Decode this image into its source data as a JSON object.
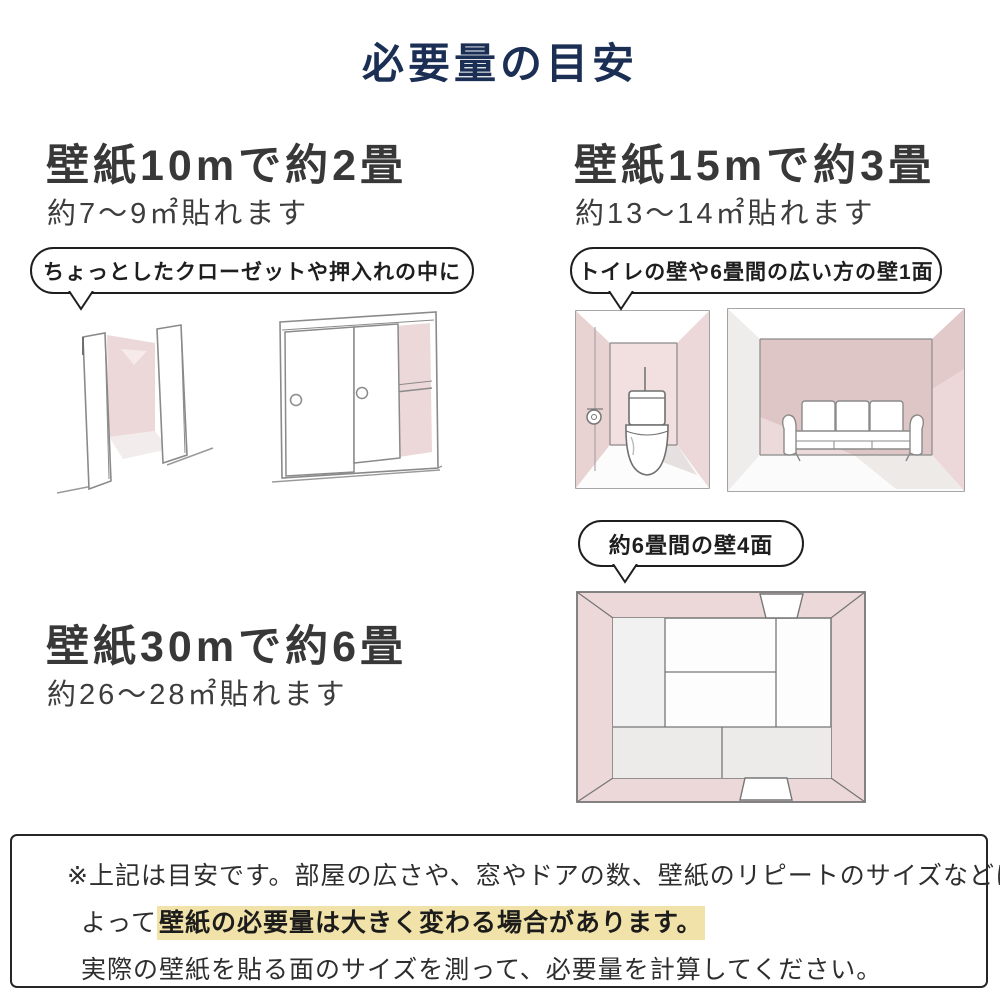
{
  "title": "必要量の目安",
  "sections": [
    {
      "heading": "壁紙10mで約2畳",
      "subheading": "約7〜9㎡貼れます",
      "bubble": "ちょっとしたクローゼットや押入れの中に"
    },
    {
      "heading": "壁紙15mで約3畳",
      "subheading": "約13〜14㎡貼れます",
      "bubble": "トイレの壁や6畳間の広い方の壁1面"
    },
    {
      "heading": "壁紙30mで約6畳",
      "subheading": "約26〜28㎡貼れます",
      "bubble": "約6畳間の壁4面"
    }
  ],
  "note": {
    "line1": "※上記は目安です。部屋の広さや、窓やドアの数、壁紙のリピートのサイズなどに",
    "line2_prefix": "よって",
    "line2_highlight": "壁紙の必要量は大きく変わる場合があります。",
    "line3": "実際の壁紙を貼る面のサイズを測って、必要量を計算してください。"
  },
  "colors": {
    "title_navy": "#1b2e54",
    "text_dark": "#383838",
    "wall_pink": "#ecd8d8",
    "wall_pink_dark": "#dfc6c6",
    "highlight_yellow": "#f0e2a8",
    "sketch_gray": "#8a8a8a"
  },
  "illustrations": [
    {
      "name": "open-closet"
    },
    {
      "name": "sliding-door-closet"
    },
    {
      "name": "toilet-room"
    },
    {
      "name": "sofa-room"
    },
    {
      "name": "tatami-room-top-view"
    }
  ]
}
